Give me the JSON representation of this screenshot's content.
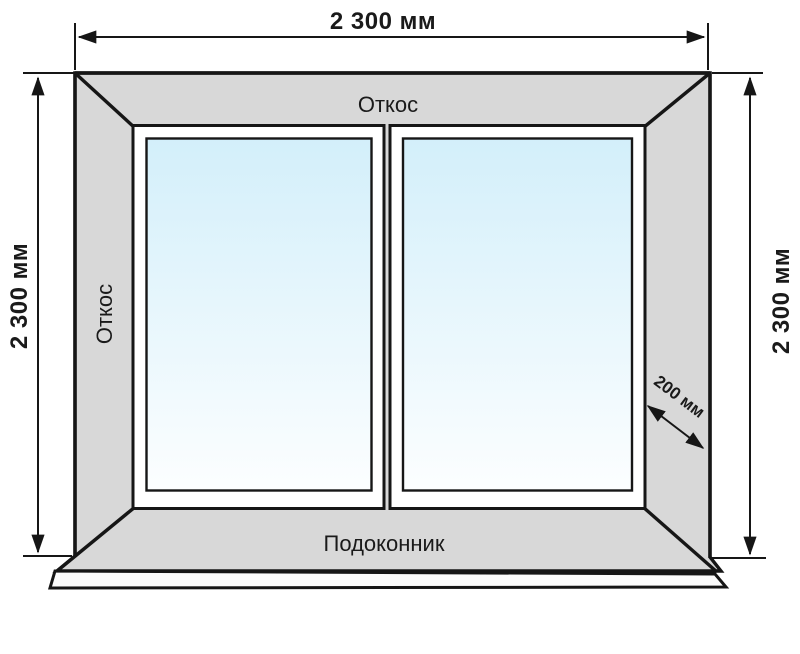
{
  "diagram": {
    "dim_width_top": "2 300 мм",
    "dim_height_left": "2 300 мм",
    "dim_height_right": "2 300 мм",
    "dim_depth": "200 мм",
    "label_slope_top": "Откос",
    "label_slope_left": "Откос",
    "label_sill": "Подоконник"
  },
  "colors": {
    "line": "#161616",
    "text": "#1a1a1a",
    "reveal_grey": "#d8d8d8",
    "sill_face": "#fcfcfc",
    "frame_white": "#ffffff",
    "glass_top": "#d3effa",
    "glass_bottom": "#fcfeff",
    "background": "#ffffff"
  }
}
